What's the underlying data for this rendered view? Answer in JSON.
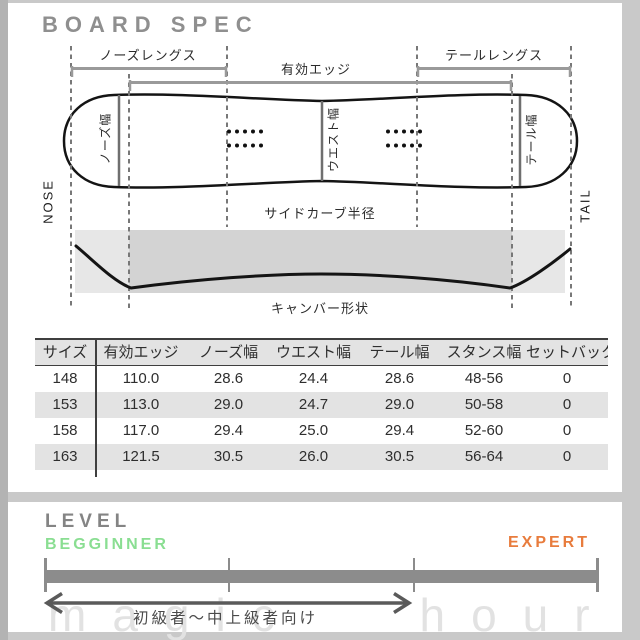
{
  "colors": {
    "beginner_green": "#8ade92",
    "expert_orange": "#e87c3d",
    "title_gray": "#8f8f8f",
    "bar_gray": "#8c8c8c",
    "camber_band_light": "#e7e7e7",
    "camber_band_dark": "#d3d3d3",
    "table_alt_row": "#e3e3e3"
  },
  "spec": {
    "title": "BOARD SPEC",
    "diagram": {
      "nose_length_label": "ノーズレングス",
      "effective_edge_label": "有効エッジ",
      "tail_length_label": "テールレングス",
      "nose_width_label": "ノーズ幅",
      "waist_width_label": "ウエスト幅",
      "tail_width_label": "テール幅",
      "nose_label": "NOSE",
      "tail_label": "TAIL",
      "sidecut_label": "サイドカーブ半径",
      "camber_label": "キャンバー形状"
    },
    "table": {
      "headers": [
        "サイズ",
        "有効エッジ",
        "ノーズ幅",
        "ウエスト幅",
        "テール幅",
        "スタンス幅",
        "セットバック"
      ],
      "rows": [
        {
          "cells": [
            "148",
            "110.0",
            "28.6",
            "24.4",
            "28.6",
            "48-56",
            "0"
          ]
        },
        {
          "cells": [
            "153",
            "113.0",
            "29.0",
            "24.7",
            "29.0",
            "50-58",
            "0"
          ]
        },
        {
          "cells": [
            "158",
            "117.0",
            "29.4",
            "25.0",
            "29.4",
            "52-60",
            "0"
          ]
        },
        {
          "cells": [
            "163",
            "121.5",
            "30.5",
            "26.0",
            "30.5",
            "56-64",
            "0"
          ]
        }
      ]
    }
  },
  "level": {
    "title": "LEVEL",
    "beginner_label": "BEGGINNER",
    "expert_label": "EXPERT",
    "range_label": "初級者～中上級者向け",
    "watermark": "magic hour"
  }
}
